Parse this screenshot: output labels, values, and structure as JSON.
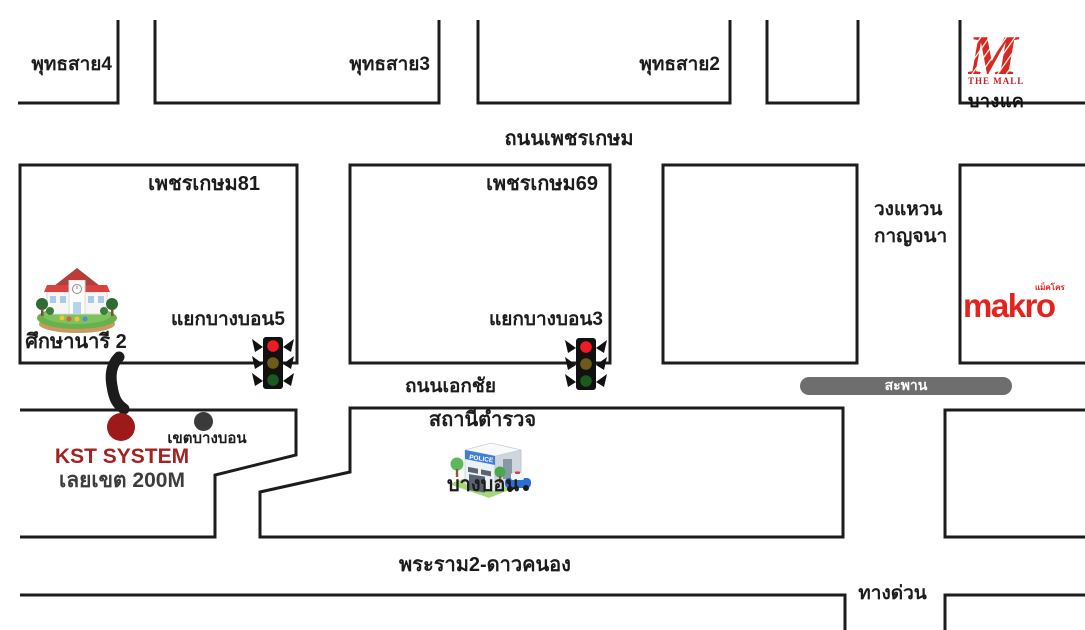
{
  "map": {
    "roads": {
      "phetkasem_label": "ถนนเพชรเกษม",
      "ekachai_label": "ถนนเอกชัย",
      "rama2_label": "พระราม2-ดาวคนอง",
      "expressway_label": "ทางด่วน",
      "bridge_label": "สะพาน",
      "kanchana_label_line1": "วงแหวน",
      "kanchana_label_line2": "กาญจนา",
      "soi_labels": [
        "พุทธสาย4",
        "พุทธสาย3",
        "พุทธสาย2"
      ],
      "block_labels": [
        "เพชรเกษม81",
        "เพชรเกษม69"
      ]
    },
    "intersections": {
      "bangbon5_label": "แยกบางบอน5",
      "bangbon3_label": "แยกบางบอน3"
    },
    "landmarks": {
      "school_label": "ศึกษานารี 2",
      "district_label": "เขตบางบอน",
      "police_label_line1": "สถานีตำรวจ",
      "police_label_line2": "บางบอน",
      "police_sign": "POLICE",
      "mall_text": "THE MALL",
      "mall_branch": "บางแค",
      "makro_text": "makro",
      "makro_thai": "แม็คโคร"
    },
    "destination": {
      "name": "KST SYSTEM",
      "note": "เลยเขต 200M"
    },
    "colors": {
      "line": "#1c1c1c",
      "destination_red": "#a32222",
      "marker_red": "#9c1a1a",
      "marker_gray": "#3a3a3a",
      "bridge_gray": "#6e6e6e",
      "brand_red": "#e4231f",
      "signal_red": "#ed1c24",
      "signal_amber": "#6d5b17",
      "signal_green": "#1a5a1f"
    }
  }
}
